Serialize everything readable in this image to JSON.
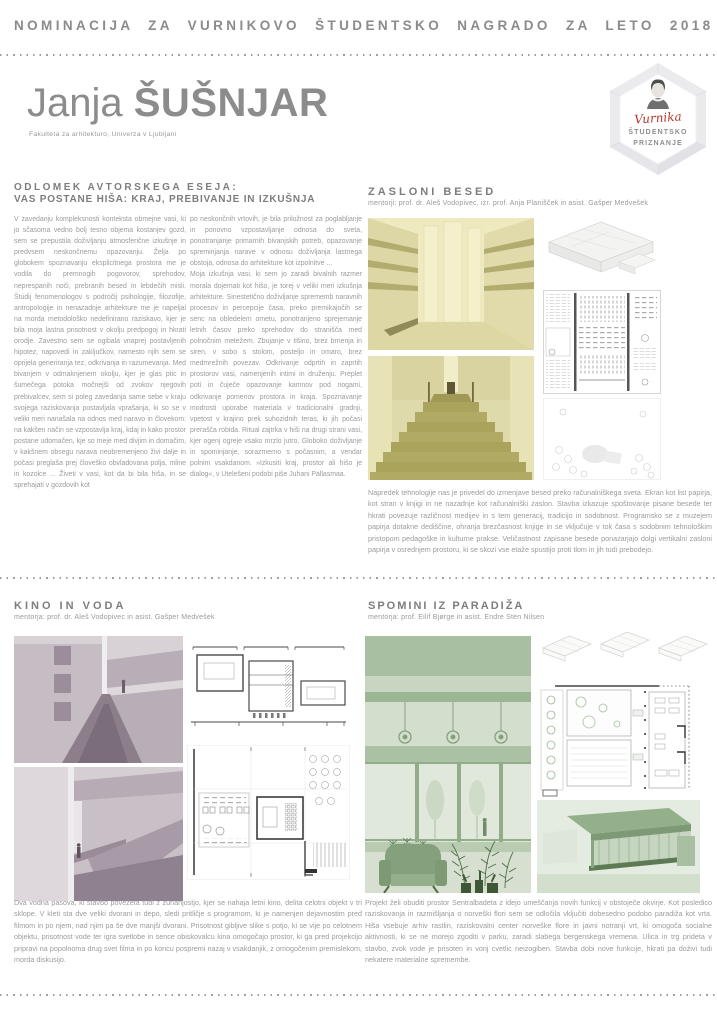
{
  "header": {
    "title": "NOMINACIJA ZA VURNIKOVO ŠTUDENTSKO NAGRADO ZA LETO 2018"
  },
  "author": {
    "first_name": "Janja",
    "last_name": "ŠUŠNJAR",
    "affiliation": "Fakulteta za arhitekturo, Univerza v Ljubljani"
  },
  "badge": {
    "signature": "Vurnika",
    "line1": "ŠTUDENTSKO",
    "line2": "PRIZNANJE"
  },
  "essay": {
    "heading_line1": "ODLOMEK AVTORSKEGA ESEJA:",
    "heading_line2": "VAS POSTANE HIŠA: KRAJ, PREBIVANJE IN IZKUŠNJA",
    "column1": "V zavedanju kompleksnosti konteksta obmejne vasi, ki jo sčasoma vedno bolj tesno objema kostanjev gozd, sem se prepustila doživljanju atmosferične izkušnje in predvsem neskončnemu opazovanju. Želja po globokem spoznavanju eksplicitnega prostora me je vodila do premnogih pogovorov, sprehodov, neprespanih noči, prebranih besed in lebdečih misli. Študij fenomenologov s področij psihologije, filozofije, antropologije in nenazadnje arhitekture me je napeljal na morda metodološko nedefinirano raziskavo, kjer je bila moja lastna prisotnost v okolju predpogoj in hkrati orodje. Zavestno sem se ogibala vnaprej postavljenih hipotez, napovedi in zaključkov, namesto njih sem se oprijela generiranja tez, odkrivanja in razumevanja. Med bivanjem v odmaknjenem okolju, kjer je glas ptic in šumečega potoka močnejši od zvokov njegovih prebivalcev, sem si poleg zavedanja same sebe v kraju svojega raziskovanja postavljala vprašanja, ki so se v veliki meri nanašala na odnos med naravo in človekom: na kakšen način se vzpostavlja kraj, kdaj in kako prostor postane udomačen, kje so meje med divjim in domačim, v kakšnem obsegu narava neobremenjeno živi dalje in počasi preglaša prej človeško obvladovana polja, mline in kozolce ... Živeti v vasi, kot da bi bila hiša, in se sprehajati v gozdovih kot",
    "column2a": "po neskončnih vrtovih, je bila priložnost za poglabljanje in ponovno vzpostavljanje odnosa do sveta, ponotranjanje primarnih bivanjskih potreb, opazovanje spreminjanja narave v odnosu doživljanja lastnega obstoja, odnosa do arhitekture kot izpolnitve ...",
    "column2b": "Moja izkušnja vasi, ki sem jo zaradi bivalnih razmer morala dojemati kot hišo, je torej v veliki meri izkušnja arhitekture. Sinestetično doživljanje sprememb naravnih procesov in percepcije časa, preko premikajočih se senc na obledelem ometu, ponotranjeno sprejemanje letnih časov preko sprehodov do stranišča med polnočnim metežem. Zbujanje v tišino, brez brnenja in siren, v sobo s stolom, posteljo in omaro, brez medmrežnih povezav. Odkrivanje odprtih in zaprtih prostorov vasi, namenjenih intimi in druženju. Preplet poti in čuječe opazovanje kamnov pod nogami, odkrivanje pomenov prostora in kraja. Spoznavanje modrosti uporabe materiala v tradicionalni gradnji, vpetost v krajino prek suhozidnih teras, ki jih počasi prerašča robida. Ritual zajtrka v hiši na drugi strani vasi, kjer ogenj ogreje vsako mrzlo jutro. Globoko doživljanje in spominjanje, sorazmerno s počasnim, a vendar polnim vsakdanom. »Izkusiti kraj, prostor ali hišo je dialog«, v Utelešeni podobi piše Juhani Pallasmaa."
  },
  "projects": [
    {
      "title": "ZASLONI BESED",
      "mentors": "mentorji: prof. dr. Aleš Vodopivec, izr. prof. Anja Planišček in asist. Gašper Medvešek",
      "description": "Napredek tehnologije nas je privedel do izmenjave besed preko računalniškega sveta. Ekran kot list papirja, kot stran v knjigi in ne nazadnje kot računalniški zaslon. Stavba izkazuje spoštovanje pisane besede ter hkrati povezuje različnost medijev in s tem generacij, tradicijo in sodobnost. Programsko se z muzejem papirja dotakne dediščine, ohranja brezčasnost knjige in se vključuje v tok časa s sodobnim tehnološkim pristopom pedagoške in kulturne prakse. Veličastnost zapisane besede ponazarjajo dolgi vertikalni zasloni papirja v osrednjem prostoru, ki se skozi vse etaže spustijo proti tlom in jih tudi prebodejo.",
      "images": [
        "interior-paper-screens-render",
        "grand-staircase-render",
        "axonometric-drawing",
        "floor-plan-drawing",
        "site-plan-drawing"
      ]
    },
    {
      "title": "KINO IN VODA",
      "mentors": "mentorja: prof. dr. Aleš Vodopivec in asist. Gašper Medvešek",
      "description": "Dva vodna pasova, ki stavbo povežeta tudi z zunanjostjo, kjer se nahaja letni kino, delita celotni objekt v tri sklope. V kleti sta dve veliki dvorani in depo, sledi pritličje s programom, ki je namenjen dejavnostim pred filmom in po njem, nad njim pa še dve manjši dvorani. Prisotnost gibljive slike s potjo, ki se vije po celotnem objektu, prisotnost vode ter igra svetlobe in sence obiskovalcu kina omogočajo prostor, ki ga pred projekcijo pripravi na popolnoma drug svet filma in po koncu pospremi nazaj v vsakdanjik, z omogočenim premislekom, morda diskusijo.",
      "images": [
        "corridor-water-render",
        "interior-ramp-render",
        "section-drawing",
        "floor-plan-drawing"
      ]
    },
    {
      "title": "SPOMINI IZ PARADIŽA",
      "mentors": "mentorja: prof. Eilif Bjørge in asist. Endre Sten Nilsen",
      "description": "Projekt želi obuditi prostor Sentralbadeta z idejo umeščanja novih funkcij v obstoječe okvirje. Kot posledico raziskovanja in razmišljanja o norveški flori sem se odločila vključiti dobesedno podobo paradiža kot vrta. Hiša vsebuje arhiv rastlin, raziskovalni center norveške flore in javni notranji vrt, ki omogoča socialne aktivnosti, ki se ne morejo zgoditi v parku, zaradi slabega bergenskega vremena. Ulica in trg prideta v stavbo, zvok vode je prisoten in vonj cvetlic neizogiben. Stavba dobi nove funkcije, hkrati pa doživi tudi nekatere materialne spremembe.",
      "images": [
        "winter-garden-interior-render",
        "axonometric-drawings",
        "floor-plan-drawing",
        "exterior-building-render"
      ]
    }
  ],
  "colors": {
    "signature_red": "#b5382f",
    "heading_grey": "#7d7d7d",
    "body_text_grey": "#9b9b9b",
    "project1_olive": "#a9a35c",
    "project1_pale_olive": "#eae5ba",
    "project2_mauve": "#a294a1",
    "project2_pale_mauve": "#cdc5cb",
    "project3_green": "#8fac87",
    "project3_pale_green": "#d3dccc"
  }
}
